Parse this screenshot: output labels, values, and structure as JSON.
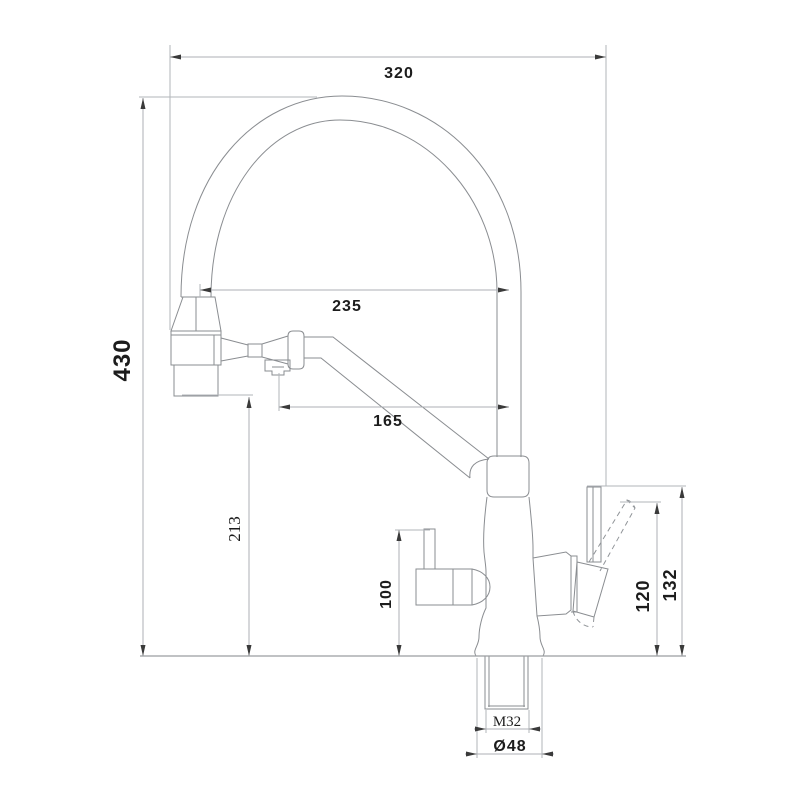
{
  "diagram": {
    "dimensions": {
      "overall_width": "320",
      "overall_height": "430",
      "spout_offset": "235",
      "arm_offset": "165",
      "spray_head_height": "213",
      "filter_handle_height": "100",
      "lever_tilted_height": "120",
      "lever_top_height": "132",
      "thread_size": "M32",
      "base_diameter": "Ø48"
    }
  }
}
